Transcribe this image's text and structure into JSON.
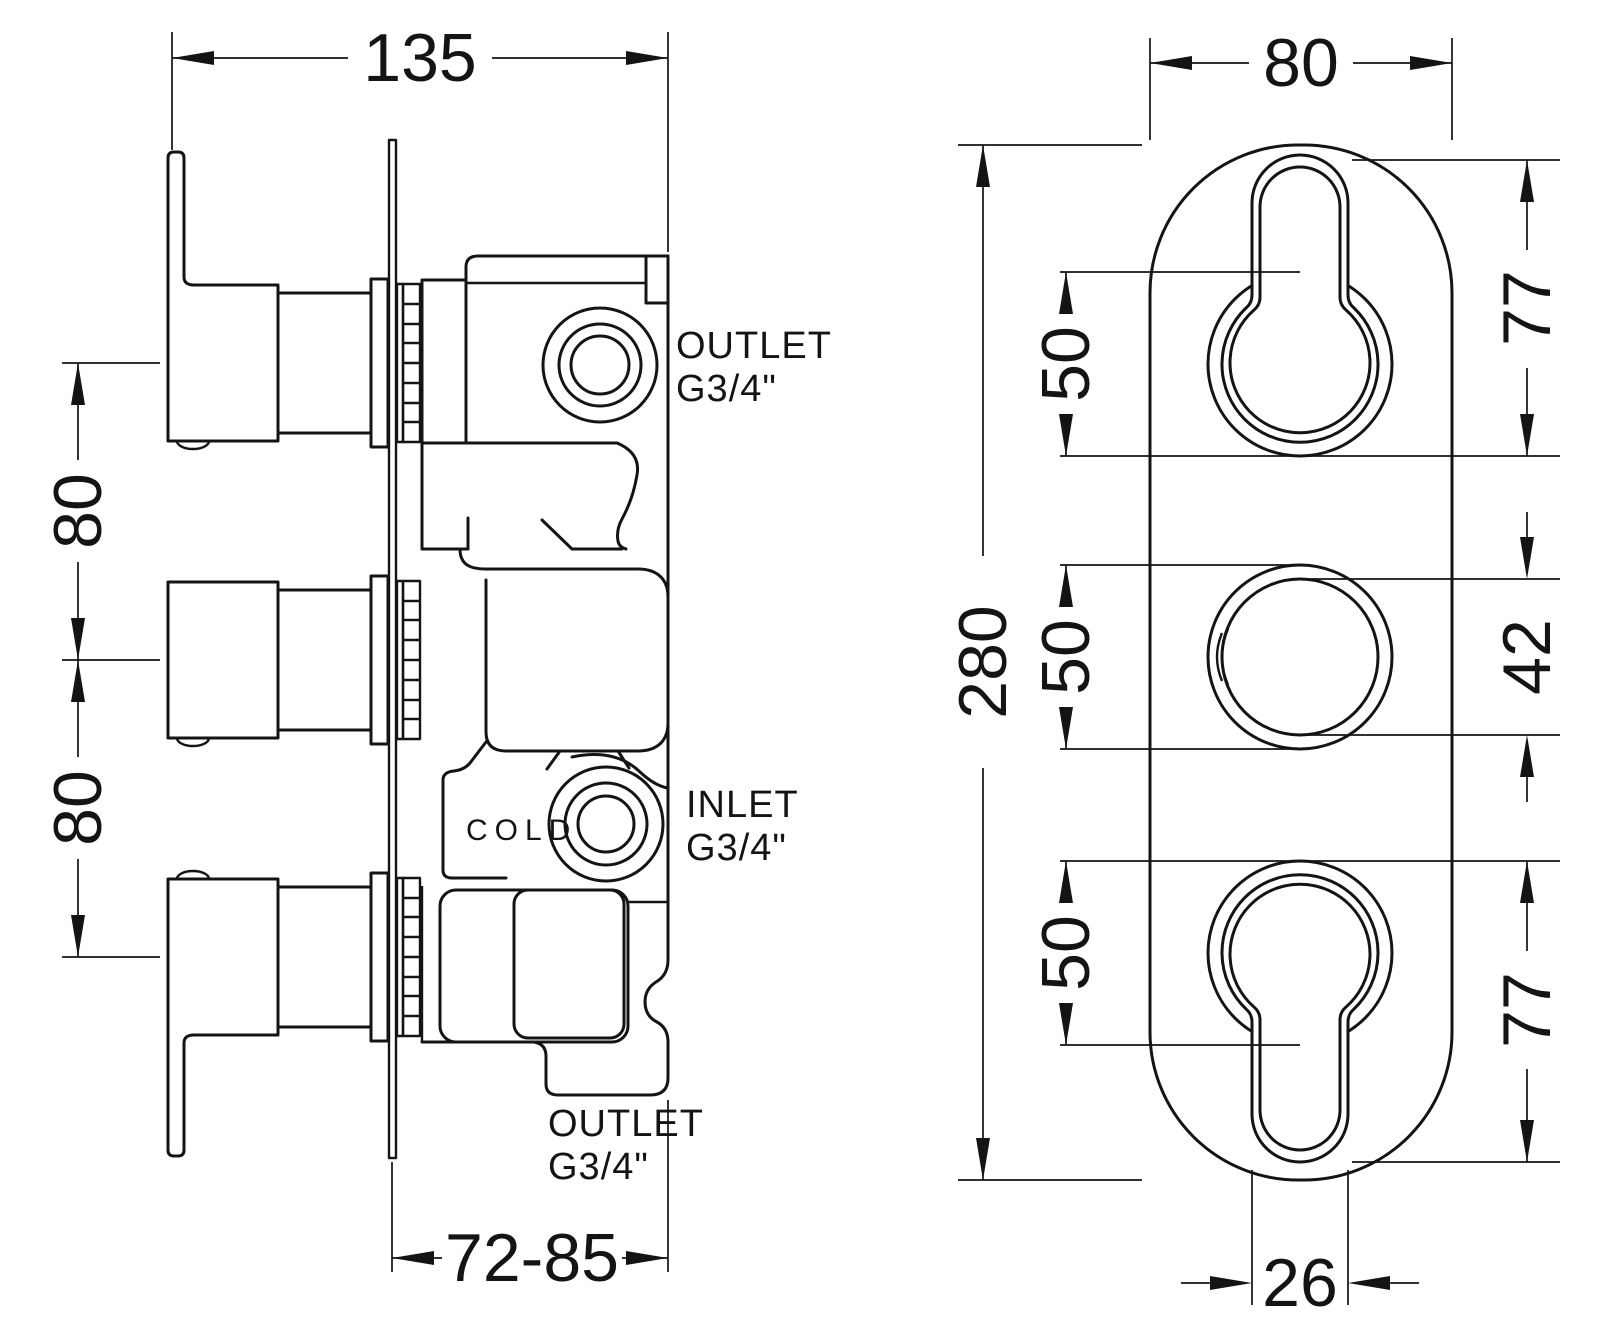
{
  "colors": {
    "line": "#141414",
    "background": "#ffffff"
  },
  "side_view": {
    "dimensions": {
      "overall_width": "135",
      "handle_spacing_upper": "80",
      "handle_spacing_lower": "80",
      "wall_depth_range": "72-85"
    },
    "labels": {
      "outlet_top_line1": "OUTLET",
      "outlet_top_line2": "G3/4\"",
      "inlet_line1": "INLET",
      "inlet_line2": "G3/4\"",
      "outlet_bottom_line1": "OUTLET",
      "outlet_bottom_line2": "G3/4\"",
      "cold_marking": "COLD"
    }
  },
  "front_view": {
    "dimensions": {
      "plate_width": "80",
      "plate_height": "280",
      "knob_top_recess": "50",
      "knob_middle_recess": "50",
      "knob_bottom_recess": "50",
      "top_cutout_height": "77",
      "middle_knob_diameter": "42",
      "bottom_cutout_height": "77",
      "stem_width": "26"
    }
  }
}
